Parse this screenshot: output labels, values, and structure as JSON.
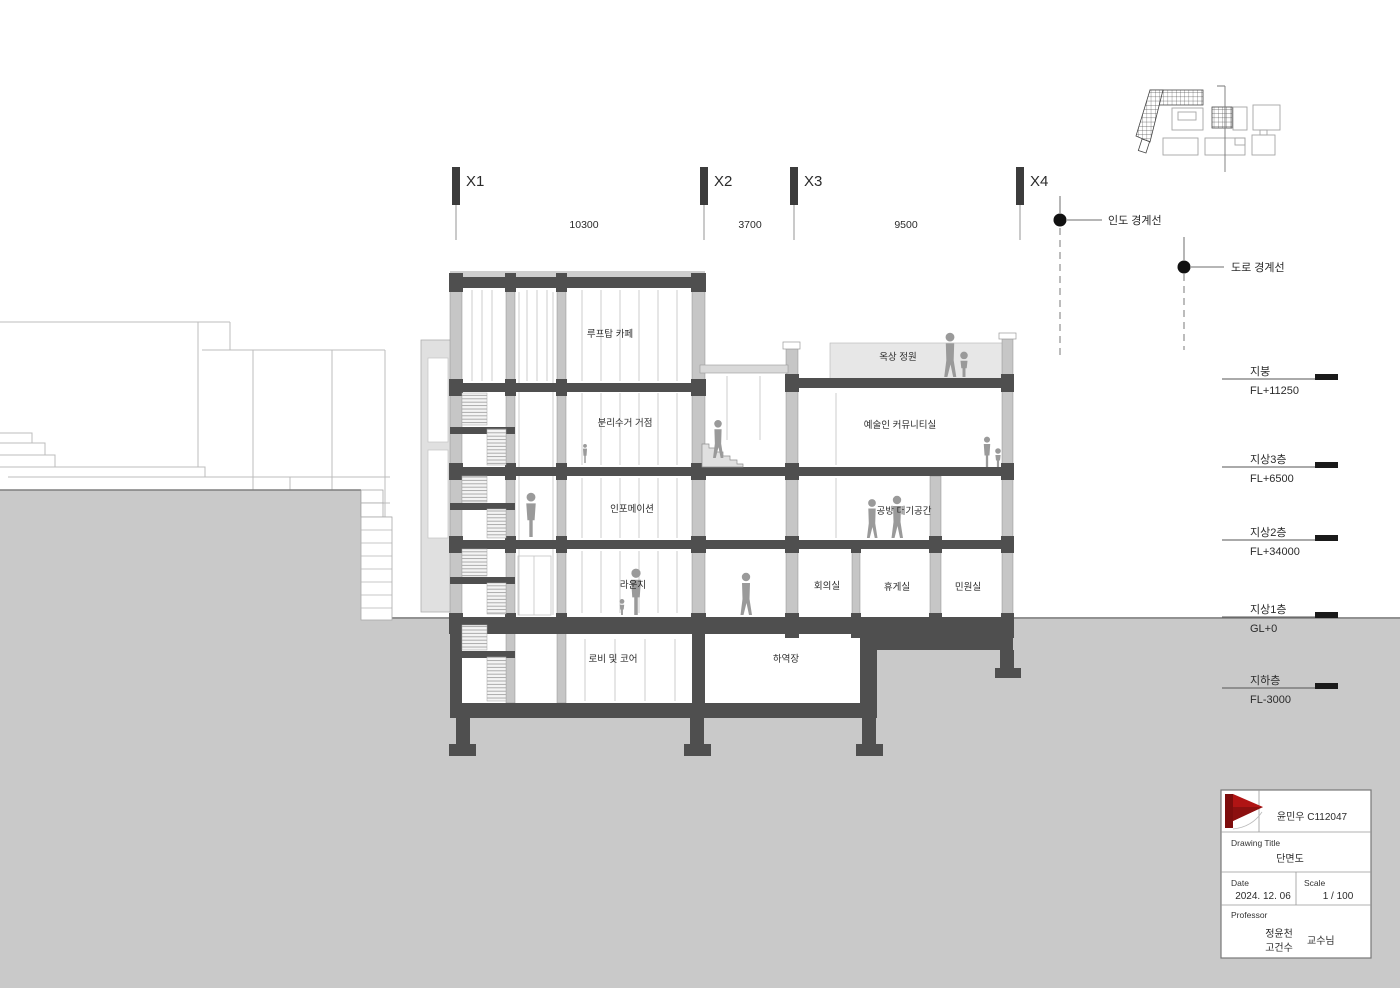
{
  "drawing": {
    "grid": {
      "labels": [
        "X1",
        "X2",
        "X3",
        "X4"
      ],
      "dimensions": [
        "10300",
        "3700",
        "9500"
      ]
    },
    "boundaries": {
      "sidewalk": "인도 경계선",
      "road": "도로 경계선"
    },
    "levels": [
      {
        "name": "지붕",
        "value": "FL+11250"
      },
      {
        "name": "지상3층",
        "value": "FL+6500"
      },
      {
        "name": "지상2층",
        "value": "FL+34000"
      },
      {
        "name": "지상1층",
        "value": "GL+0"
      },
      {
        "name": "지하층",
        "value": "FL-3000"
      }
    ],
    "rooms": {
      "rooftop_cafe": "루프탑 카페",
      "recycling_hub": "분리수거 거점",
      "information": "인포메이션",
      "lounge": "라운지",
      "lobby_core": "로비 및 코어",
      "loading_dock": "하역장",
      "roof_garden": "옥상 정원",
      "artist_community": "예술인 커뮤니티실",
      "workshop_waiting": "공방 대기공간",
      "meeting_room": "회의실",
      "rest_room": "휴게실",
      "civil_room": "민원실"
    }
  },
  "title_block": {
    "author": "윤민우 C112047",
    "drawing_title_label": "Drawing Title",
    "drawing_title": "단면도",
    "date_label": "Date",
    "date": "2024. 12. 06",
    "scale_label": "Scale",
    "scale": "1 / 100",
    "professor_label": "Professor",
    "professor_name1": "정윤천",
    "professor_name2": "고건수",
    "professor_suffix": "교수님"
  },
  "colors": {
    "dark_structure": "#4f4f4f",
    "wall_gray": "#c6c6c6",
    "ground_gray": "#c9c9c9",
    "deck_gray": "#e7e7e7",
    "figure_gray": "#9a9a9a",
    "flag_red": "#b01414",
    "flag_dark": "#7d0d0d"
  }
}
